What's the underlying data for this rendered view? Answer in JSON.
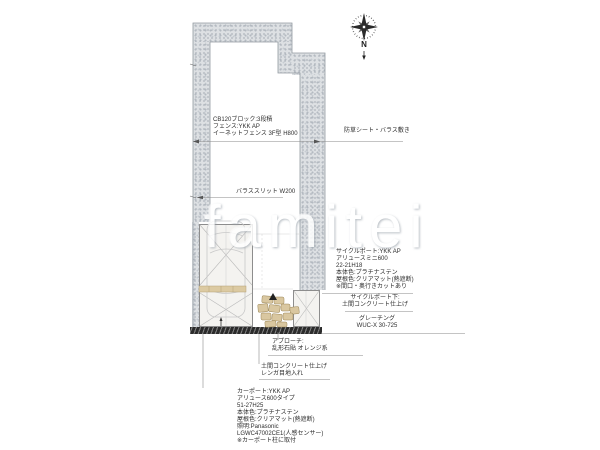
{
  "watermark": {
    "text": "famitei"
  },
  "compass": {
    "label": "N"
  },
  "labels": {
    "block_fence": "CB120ブロック:3段積\nフェンス:YKK AP\nイーネットフェンス 3F型 H800",
    "weed_sheet": "防草シート・バラス敷き",
    "gravel_slit": "バラススリット W200",
    "cycleport_spec": "サイクルポート:YKK AP\nアリュースミニ600\n22-21H18\n本体色:プラチナステン\n屋根色:クリアマット(熱遮断)\n※間口・奥行きカットあり",
    "cycleport_under": "サイクルポート下:\n土間コンクリート仕上げ",
    "grating": "グレーチング\nWUC-X 30-725",
    "approach": "アプローチ:\n乱形石貼 オレンジ系",
    "doma_concrete": "土間コンクリート仕上げ\nレンガ目地入れ",
    "carport_spec": "カーポート:YKK AP\nアリュース600タイプ\n51-27H25\n本体色:プラチナステン\n屋根色:クリアマット(熱遮断)\n照明:Panasonic\nLGWC47002CE1(人感センサー)\n※カーポート柱に取付"
  },
  "colors": {
    "gravel": "#dde0e3",
    "stone_tan": "#d9c7a0",
    "band_dark": "#2b2b2b",
    "line_gray": "#8a8a8a",
    "paper": "#ffffff"
  }
}
